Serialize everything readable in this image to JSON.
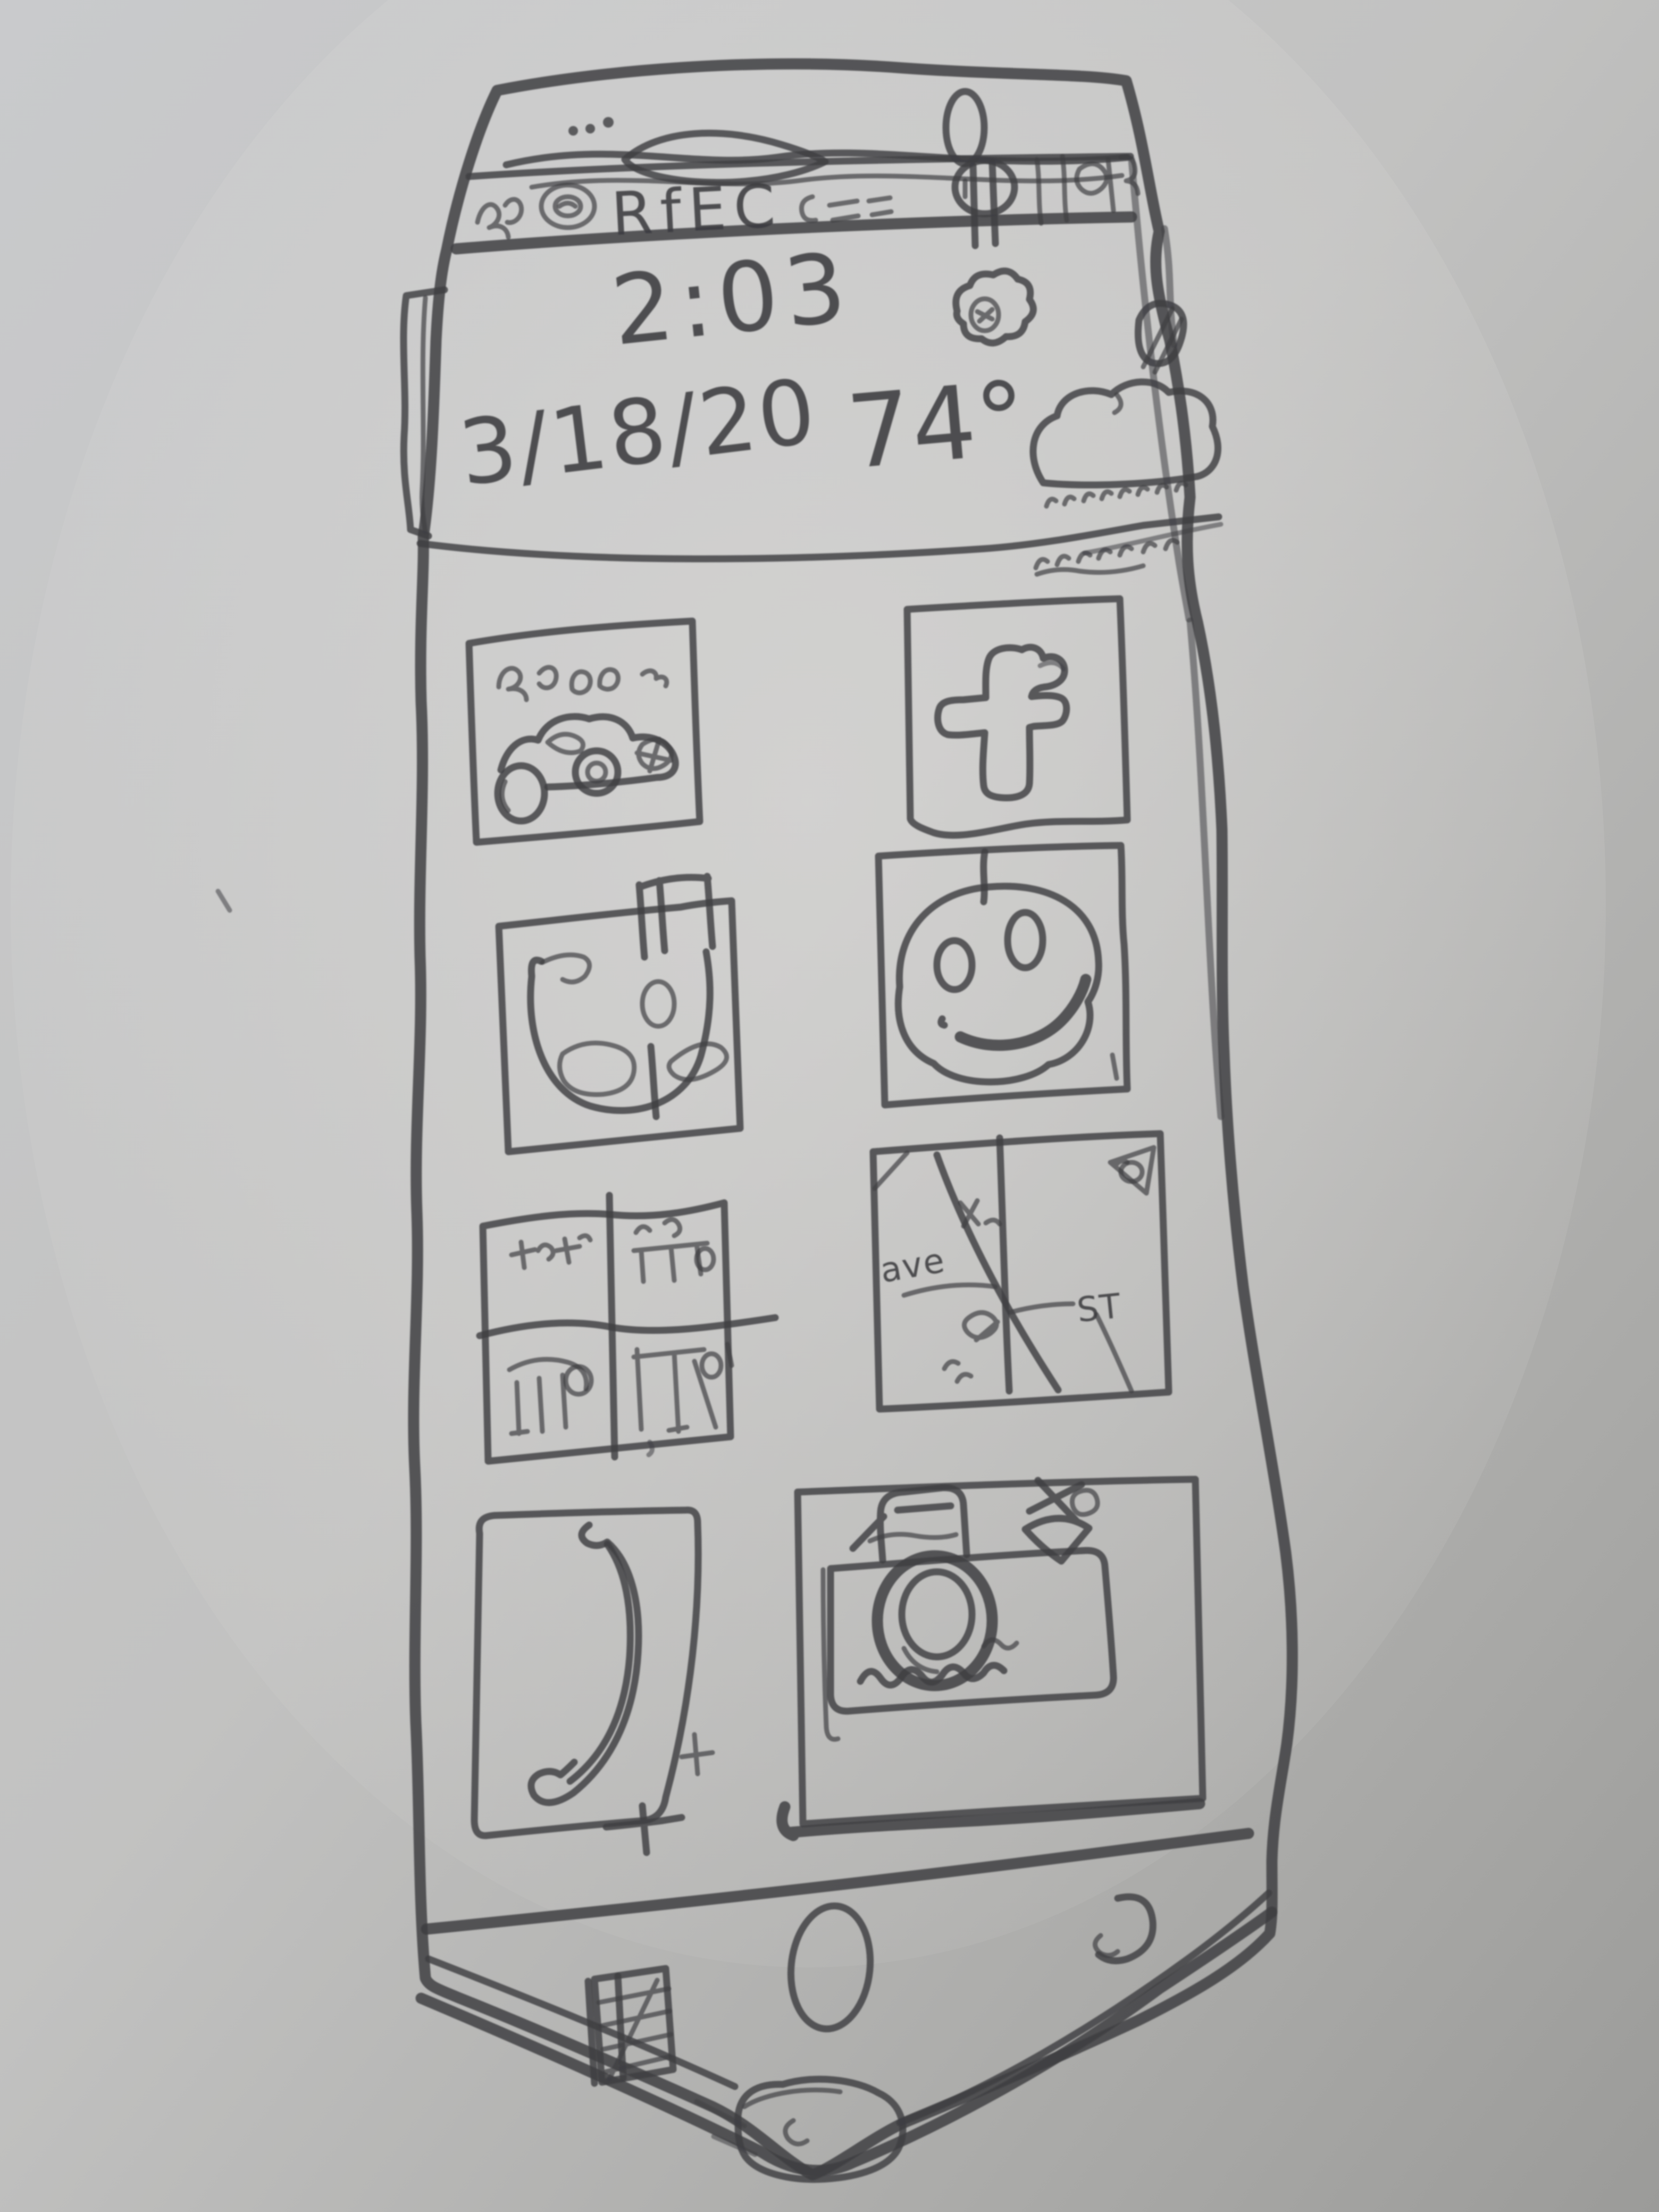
{
  "meta": {
    "title": "Hand-drawn smartphone home screen sketch on gray paper"
  },
  "colors": {
    "paper_light": "#cdced0",
    "paper_mid": "#bfbfbe",
    "paper_dark": "#9b9b99",
    "ink": "#3e3e42"
  },
  "status_bar": {
    "letters": "RfEC",
    "description": "scribbled signal, alarm and battery status icons"
  },
  "header": {
    "time": "2:03",
    "date": "3/18/20",
    "temperature": "74°"
  },
  "weather": {
    "condition": "rain cloud with falling rain dashes",
    "sun_flower_doodle": "scribbled sun/flower next to time"
  },
  "apps": [
    {
      "id": "car",
      "label": "car racing app"
    },
    {
      "id": "facebook",
      "label": "facebook"
    },
    {
      "id": "doodle",
      "label": "horseshoe doodle app"
    },
    {
      "id": "smiley",
      "label": "smiley face app"
    },
    {
      "id": "gallery",
      "label": "photo gallery grid"
    },
    {
      "id": "maps",
      "label": "street maps"
    },
    {
      "id": "phone",
      "label": "phone dialer"
    },
    {
      "id": "camera",
      "label": "camera"
    }
  ],
  "map_icon_labels": {
    "avenue": "ave",
    "street": "ST"
  },
  "nav_bar": {
    "items": [
      "recents",
      "home",
      "back"
    ]
  }
}
